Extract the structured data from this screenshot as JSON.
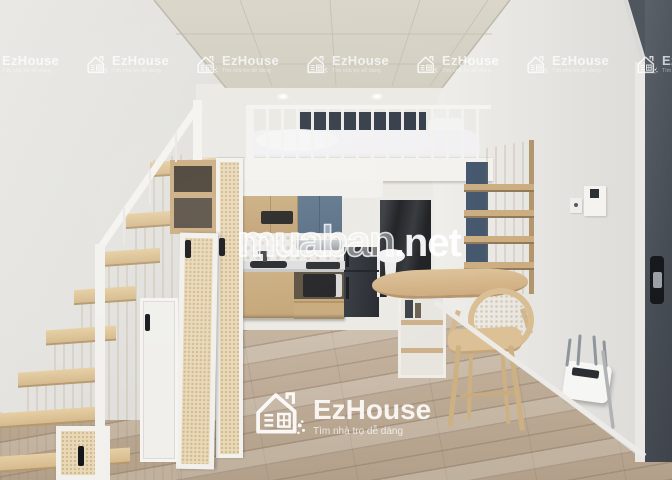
{
  "watermarks": {
    "brand_name": "EzHouse",
    "brand_tagline": "Tìm nhà trọ dễ dàng",
    "site_name": "muaban",
    "site_suffix": ".net"
  },
  "palette": {
    "wood": "#c9ab7e",
    "light_wood": "#dcc096",
    "blue_cabinet": "#5d7389",
    "navy_panel": "#41546a",
    "entry_door_gray": "#4b5158",
    "floor_wood": "#bfae9a",
    "ceiling_cream": "#d8d4c7",
    "wall_light": "#e6e4e0",
    "watermark_white": "#ffffff"
  }
}
